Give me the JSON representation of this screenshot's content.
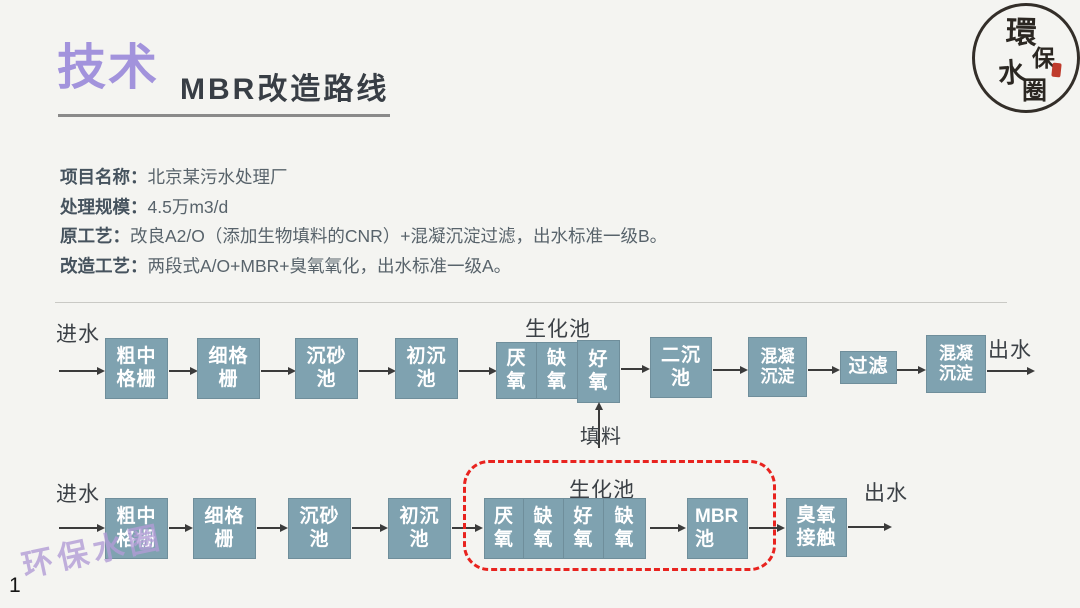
{
  "slide": {
    "page_number": "1",
    "watermark": "环保水圈"
  },
  "header": {
    "title_accent": "技术",
    "title_main": "MBR改造路线"
  },
  "logo": {
    "char_1": "環",
    "char_2": "保",
    "char_3": "水",
    "char_4": "圈"
  },
  "info": {
    "items": [
      {
        "label": "项目名称：",
        "value": "北京某污水处理厂"
      },
      {
        "label": "处理规模：",
        "value": "4.5万m3/d"
      },
      {
        "label": "原工艺：",
        "value": "改良A2/O（添加生物填料的CNR）+混凝沉淀过滤，出水标准一级B。"
      },
      {
        "label": "改造工艺：",
        "value": "两段式A/O+MBR+臭氧氧化，出水标准一级A。"
      }
    ]
  },
  "flow_old": {
    "inlet_label": "进水",
    "outlet_label": "出水",
    "bio_group_label": "生化池",
    "filler_label": "填料",
    "boxes": {
      "coarse_screen": {
        "l1": "粗中",
        "l2": "格栅"
      },
      "fine_screen": {
        "l1": "细格",
        "l2": "栅"
      },
      "grit_chamber": {
        "l1": "沉砂",
        "l2": "池"
      },
      "primary_tank": {
        "l1": "初沉",
        "l2": "池"
      },
      "anaerobic": {
        "l1": "厌",
        "l2": "氧"
      },
      "anoxic": {
        "l1": "缺",
        "l2": "氧"
      },
      "aerobic": {
        "l1": "好",
        "l2": "氧"
      },
      "secondary_tank": {
        "l1": "二沉",
        "l2": "池"
      },
      "coagulation_1": {
        "l1": "混凝",
        "l2": "沉淀"
      },
      "filtration": {
        "l1": "过滤"
      },
      "coagulation_2": {
        "l1": "混凝",
        "l2": "沉淀"
      }
    }
  },
  "flow_new": {
    "inlet_label": "进水",
    "outlet_label": "出水",
    "bio_group_label": "生化池",
    "boxes": {
      "coarse_screen": {
        "l1": "粗中",
        "l2": "格栅"
      },
      "fine_screen": {
        "l1": "细格",
        "l2": "栅"
      },
      "grit_chamber": {
        "l1": "沉砂",
        "l2": "池"
      },
      "primary_tank": {
        "l1": "初沉",
        "l2": "池"
      },
      "anaerobic": {
        "l1": "厌",
        "l2": "氧"
      },
      "anoxic_1": {
        "l1": "缺",
        "l2": "氧"
      },
      "aerobic": {
        "l1": "好",
        "l2": "氧"
      },
      "anoxic_2": {
        "l1": "缺",
        "l2": "氧"
      },
      "mbr": {
        "l1": "MBR",
        "l2": "池"
      },
      "ozone": {
        "l1": "臭氧",
        "l2": "接触"
      }
    }
  },
  "colors": {
    "accent_purple": "#a293dc",
    "box_fill": "#7fa2b0",
    "dashed_red": "#e8231f",
    "watermark_purple": "#b19cd6"
  }
}
